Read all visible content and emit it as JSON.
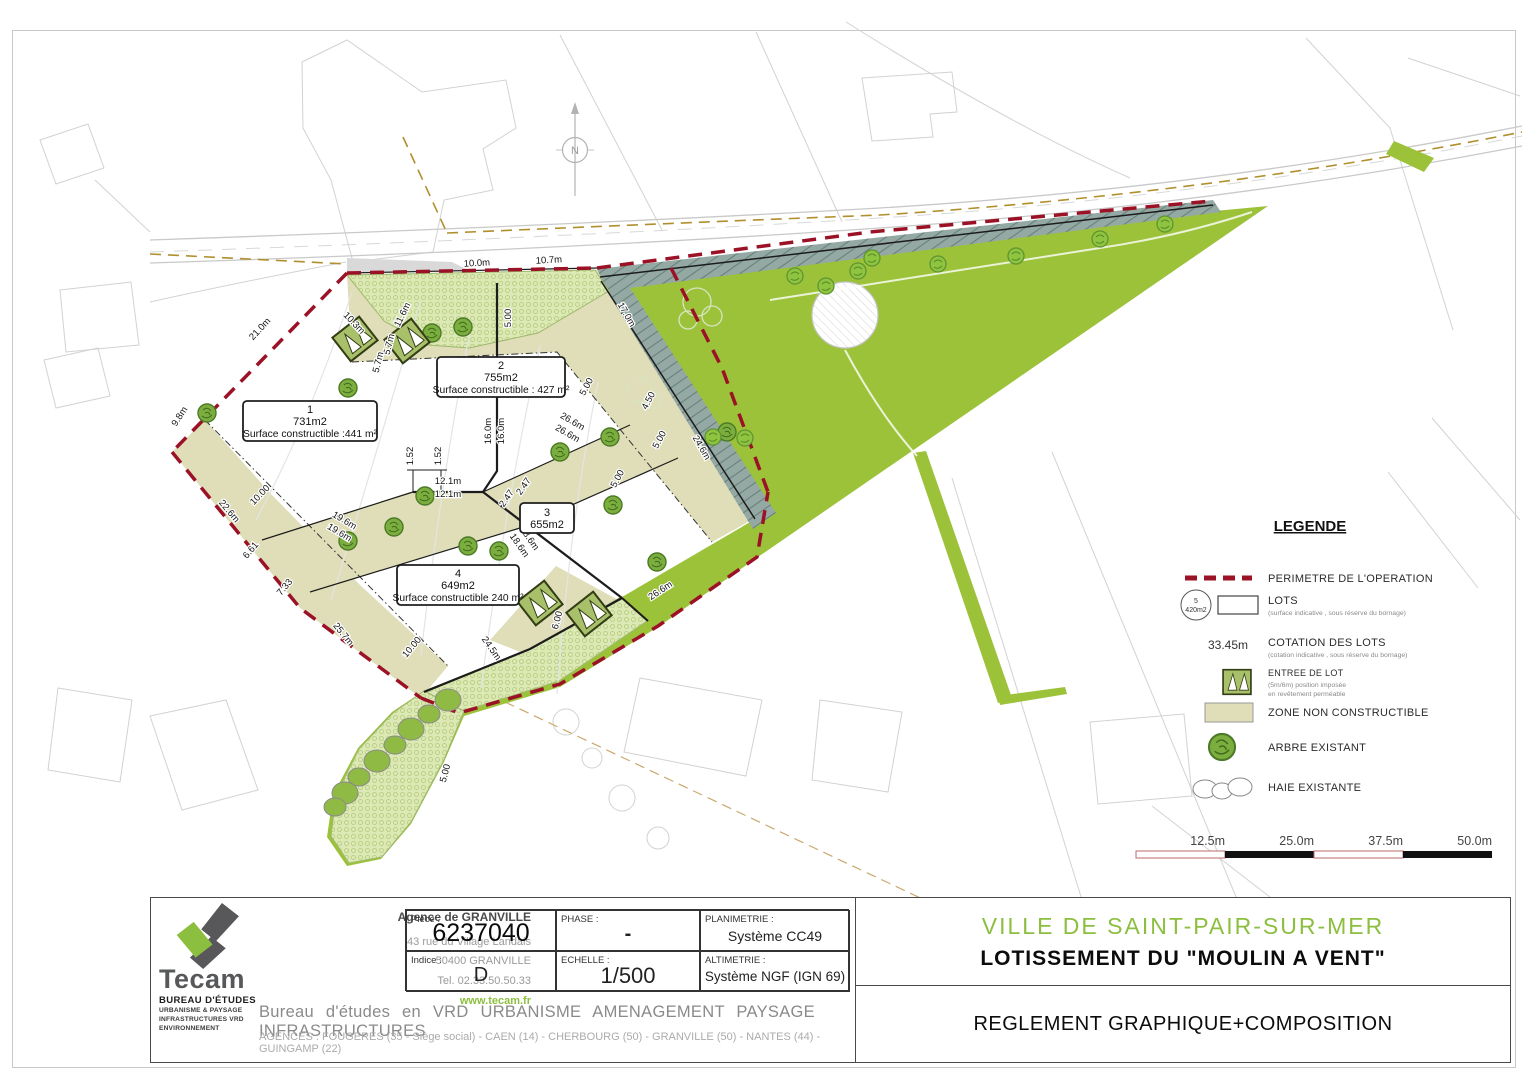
{
  "north": {
    "label": "N"
  },
  "plan": {
    "lots": [
      {
        "number": "1",
        "area": "731m2",
        "surface": "Surface constructible :441 m²"
      },
      {
        "number": "2",
        "area": "755m2",
        "surface": "Surface constructible : 427 m²"
      },
      {
        "number": "3",
        "area": "655m2",
        "surface": ""
      },
      {
        "number": "4",
        "area": "649m2",
        "surface": "Surface constructible 240 m²"
      }
    ],
    "dimensions": [
      {
        "text": "10.0m",
        "x": 477,
        "y": 266,
        "r": -3
      },
      {
        "text": "10.7m",
        "x": 549,
        "y": 263,
        "r": -3
      },
      {
        "text": "21.0m",
        "x": 262,
        "y": 331,
        "r": -47
      },
      {
        "text": "9.8m",
        "x": 182,
        "y": 418,
        "r": -57
      },
      {
        "text": "22.6m",
        "x": 227,
        "y": 513,
        "r": 50
      },
      {
        "text": "25.7m",
        "x": 341,
        "y": 636,
        "r": 51
      },
      {
        "text": "10.3m",
        "x": 352,
        "y": 325,
        "r": 46
      },
      {
        "text": "11.6m",
        "x": 405,
        "y": 316,
        "r": -64
      },
      {
        "text": "5.7m",
        "x": 392,
        "y": 345,
        "r": -76
      },
      {
        "text": "5.7m",
        "x": 381,
        "y": 363,
        "r": -76
      },
      {
        "text": "16.0m",
        "x": 491,
        "y": 431,
        "r": -90
      },
      {
        "text": "16.0m",
        "x": 504,
        "y": 431,
        "r": -90
      },
      {
        "text": "12.1m",
        "x": 448,
        "y": 484,
        "r": 0
      },
      {
        "text": "12.1m",
        "x": 448,
        "y": 497,
        "r": 0
      },
      {
        "text": "26.6m",
        "x": 571,
        "y": 424,
        "r": 30
      },
      {
        "text": "26.6m",
        "x": 566,
        "y": 436,
        "r": 30
      },
      {
        "text": "19.6m",
        "x": 343,
        "y": 523,
        "r": 31
      },
      {
        "text": "19.6m",
        "x": 338,
        "y": 535,
        "r": 31
      },
      {
        "text": "18.6m",
        "x": 527,
        "y": 540,
        "r": 55
      },
      {
        "text": "18.6m",
        "x": 517,
        "y": 547,
        "r": 55
      },
      {
        "text": "17.0m",
        "x": 624,
        "y": 316,
        "r": 60
      },
      {
        "text": "24.6m",
        "x": 699,
        "y": 449,
        "r": 60
      },
      {
        "text": "26.6m",
        "x": 662,
        "y": 593,
        "r": -33
      },
      {
        "text": "24.5m",
        "x": 489,
        "y": 650,
        "r": 55
      },
      {
        "text": "5.00",
        "x": 511,
        "y": 318,
        "r": -90
      },
      {
        "text": "5.00",
        "x": 589,
        "y": 388,
        "r": -62
      },
      {
        "text": "5.00",
        "x": 662,
        "y": 441,
        "r": -62
      },
      {
        "text": "4.50",
        "x": 651,
        "y": 402,
        "r": -62
      },
      {
        "text": "10.00",
        "x": 262,
        "y": 497,
        "r": -46
      },
      {
        "text": "10.00",
        "x": 414,
        "y": 649,
        "r": -50
      },
      {
        "text": "6.61",
        "x": 253,
        "y": 552,
        "r": -50
      },
      {
        "text": "7.33",
        "x": 287,
        "y": 589,
        "r": -50
      },
      {
        "text": "1.52",
        "x": 413,
        "y": 456,
        "r": -90
      },
      {
        "text": "1.52",
        "x": 441,
        "y": 456,
        "r": -90
      },
      {
        "text": "2.47",
        "x": 509,
        "y": 500,
        "r": -55
      },
      {
        "text": "2.47",
        "x": 526,
        "y": 488,
        "r": -55
      },
      {
        "text": "5.00",
        "x": 448,
        "y": 774,
        "r": -75
      },
      {
        "text": "6.00",
        "x": 560,
        "y": 621,
        "r": -75
      },
      {
        "text": "5.00",
        "x": 620,
        "y": 480,
        "r": -62
      }
    ]
  },
  "legend": {
    "title": "LEGENDE",
    "items": [
      {
        "label": "PERIMETRE DE L'OPERATION"
      },
      {
        "label": "LOTS",
        "sub": "(surface indicative , sous réserve du bornage)",
        "badge_number": "5",
        "badge_area": "420m2"
      },
      {
        "symbol": "33.45m",
        "label": "COTATION DES LOTS",
        "sub": "(cotation indicative , sous réserve du bornage)"
      },
      {
        "label": "ENTREE DE LOT",
        "sub": "(5m/6m) position imposée",
        "sub2": "en revêtement perméable"
      },
      {
        "label": "ZONE NON CONSTRUCTIBLE"
      },
      {
        "label": "ARBRE EXISTANT"
      },
      {
        "label": "HAIE EXISTANTE"
      }
    ]
  },
  "scale_bar": {
    "labels": [
      "12.5m",
      "25.0m",
      "37.5m",
      "50.0m"
    ]
  },
  "title_block": {
    "logo": {
      "name": "Tecam",
      "subtitle": "BUREAU D'ÉTUDES",
      "lines": [
        "URBANISME & PAYSAGE",
        "INFRASTRUCTURES VRD",
        "ENVIRONNEMENT"
      ]
    },
    "agency": {
      "title": "Agence de GRANVILLE",
      "address": [
        "43 rue du Village Landais",
        "50400 GRANVILLE",
        "Tel. 02.33.50.50.33"
      ],
      "website": "www.tecam.fr"
    },
    "fields": [
      {
        "label": "Pièce :",
        "value": "6237040"
      },
      {
        "label": "PHASE :",
        "value": "-"
      },
      {
        "label": "PLANIMETRIE :",
        "value": "Système CC49"
      },
      {
        "label": "Indice :",
        "value": "D"
      },
      {
        "label": "ECHELLE :",
        "value": "1/500"
      },
      {
        "label": "ALTIMETRIE :",
        "value": "Système NGF (IGN 69)"
      }
    ],
    "tagline": "Bureau d'études en VRD URBANISME AMENAGEMENT PAYSAGE INFRASTRUCTURES",
    "agencies": "AGENCES :  FOUGERES (35 - Siège social) - CAEN (14) - CHERBOURG (50) - GRANVILLE (50) - NANTES (44) - GUINGAMP (22)",
    "project": {
      "city": "VILLE DE SAINT-PAIR-SUR-MER",
      "name": "LOTISSEMENT DU \"MOULIN A VENT\"",
      "doc": "REGLEMENT GRAPHIQUE+COMPOSITION"
    }
  },
  "colors": {
    "accent_green": "#8cbf3f",
    "plan_green": "#9cc23a",
    "zone_beige": "#dfdeb8",
    "talus_gray": "#95a9a4",
    "perimeter_red": "#9b1226",
    "road_gold": "#b08f2c",
    "teal_note": "#3aa6a0"
  }
}
